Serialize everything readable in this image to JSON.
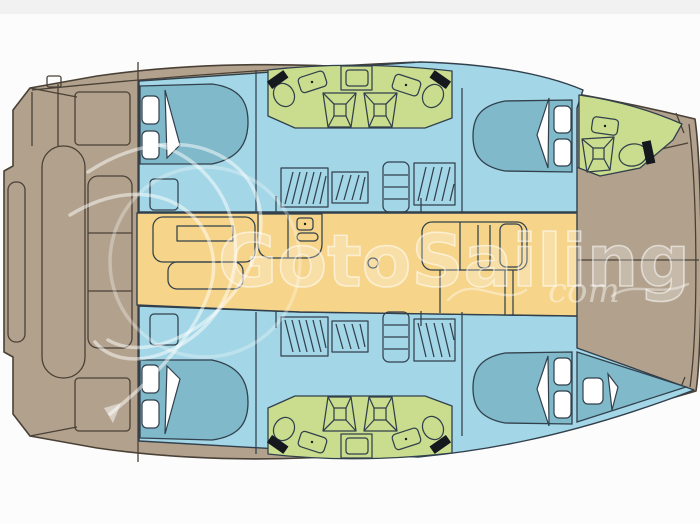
{
  "watermark": {
    "brand": "GotoSailing",
    "suffix": "com"
  },
  "colors": {
    "background": "#fcfcfc",
    "top_band": "#f1f1f2",
    "deck": "#b2a28d",
    "deck_line": "#4a4136",
    "hull": "#a3d6e6",
    "hull_line": "#31404c",
    "bed": "#7fb9ca",
    "bathroom": "#cadd8f",
    "salon": "#f6d489",
    "pillow": "#ffffff",
    "fixture_black": "#15181c",
    "watermark": "#ffffff"
  },
  "vessel": {
    "regions": [
      {
        "name": "aft-cockpit"
      },
      {
        "name": "salon"
      },
      {
        "name": "galley"
      },
      {
        "name": "nav-seating"
      },
      {
        "name": "port-aft-cabin"
      },
      {
        "name": "shared-heads-port"
      },
      {
        "name": "port-forward-cabin"
      },
      {
        "name": "port-bow-head"
      },
      {
        "name": "starboard-aft-cabin"
      },
      {
        "name": "shared-heads-starboard"
      },
      {
        "name": "starboard-forward-cabin"
      },
      {
        "name": "forepeak-berth"
      },
      {
        "name": "foredeck"
      }
    ]
  }
}
